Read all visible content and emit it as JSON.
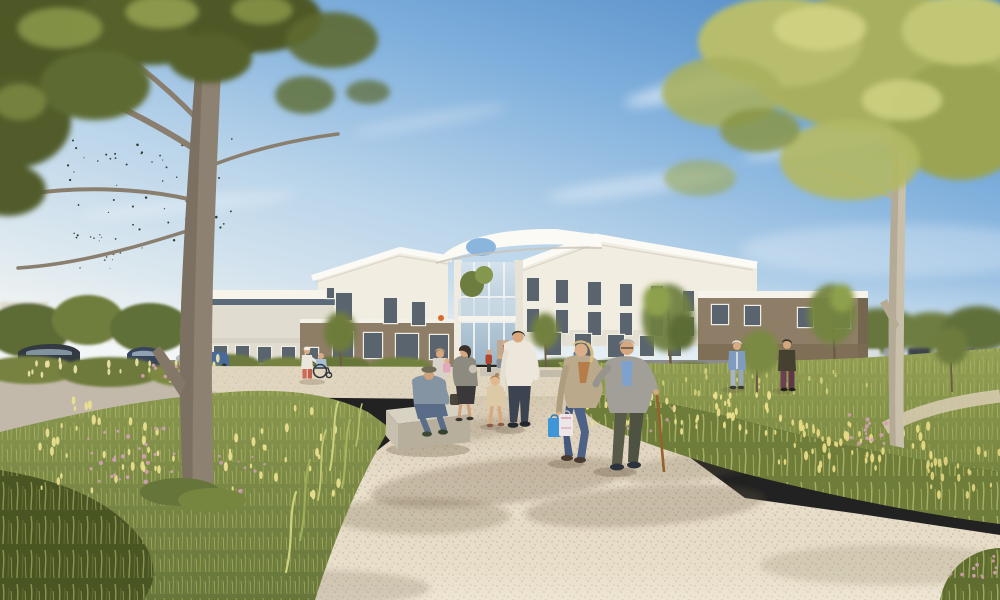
{
  "meta": {
    "type": "architectural-rendering",
    "subject": "Modern low-rise care facility with central glazed entrance, gravel promenade between wildflower meadows, large framing trees, strolling residents and visitors under a blue sky"
  },
  "palette": {
    "sky_top": "#4b86c3",
    "sky_mid": "#8db8e0",
    "sky_low": "#cfe2ec",
    "sky_horizon": "#eaf0f1",
    "cloud": "#ffffff",
    "wall_white": "#f1ede1",
    "wall_white_shade": "#e0dccf",
    "fascia_white": "#fbfaf5",
    "wall_taupe": "#8f7e67",
    "wall_taupe_dark": "#7b6b54",
    "window_glass": "#5a646f",
    "window_frame": "#f0ede3",
    "entrance_glass": "#c2d4e2",
    "gravel": "#e9dfcb",
    "gravel_speck": "#c9b89d",
    "plaza": "#e0d5bf",
    "asphalt": "#c3b9ab",
    "meadow_base": "#7e8c48",
    "meadow_light": "#a9b25e",
    "meadow_dark": "#5a6830",
    "grass_corner_dark": "#4a5524",
    "flower_yellow": "#ece28c",
    "flower_pink": "#d49fb6",
    "foliage_dark": "#4d5828",
    "foliage_mid": "#6e7a38",
    "foliage_light": "#9aa656",
    "foliage_right_mid": "#a8b05e",
    "foliage_right_light": "#c9cd7d",
    "trunk": "#8d8171",
    "trunk_shade": "#6e6355",
    "pale_trunk": "#c9c0ac",
    "path_shadow": "#6b5b43",
    "bench_top": "#d8d2c3",
    "bench_front": "#b7ae9c",
    "cane": "#96612f",
    "car_dark": "#333a42",
    "car_blue": "#36455c",
    "car_silver": "#b5bcc2",
    "roof_terracotta": "#9b6a52"
  },
  "scene": {
    "sky": {
      "birds_flock": "small flock of birds between tree branches, upper left"
    },
    "building": {
      "wings": [
        {
          "id": "left-low-wing",
          "desc": "single-storey white wing with dark clerestory band"
        },
        {
          "id": "left-gable-block",
          "desc": "two-storey white block with angled gable roof"
        },
        {
          "id": "ground-floor-taupe",
          "desc": "taupe ground-floor section with dark openings"
        },
        {
          "id": "entrance-atrium",
          "desc": "central glazed entrance with white sculptural canopy, oval roof cut-out, balcony with planting"
        },
        {
          "id": "right-gable-block",
          "desc": "three-storey white block with folded gable roof"
        },
        {
          "id": "right-brown-wing",
          "desc": "flat-roofed taupe wing with white fascia"
        }
      ],
      "windows": [
        [
          214,
          346,
          13,
          16
        ],
        [
          236,
          346,
          13,
          16
        ],
        [
          258,
          347,
          13,
          16
        ],
        [
          282,
          347,
          13,
          16
        ],
        [
          306,
          348,
          12,
          15
        ],
        [
          336,
          293,
          16,
          27
        ],
        [
          384,
          298,
          13,
          25
        ],
        [
          412,
          302,
          13,
          23
        ],
        [
          327,
          288,
          7,
          10
        ],
        [
          333,
          332,
          20,
          26
        ],
        [
          364,
          333,
          18,
          25
        ],
        [
          396,
          334,
          22,
          26
        ],
        [
          430,
          335,
          18,
          24
        ],
        [
          527,
          278,
          12,
          23
        ],
        [
          556,
          280,
          12,
          23
        ],
        [
          588,
          282,
          13,
          23
        ],
        [
          620,
          284,
          12,
          22
        ],
        [
          651,
          286,
          12,
          22
        ],
        [
          683,
          291,
          11,
          20
        ],
        [
          527,
          309,
          12,
          23
        ],
        [
          556,
          310,
          12,
          23
        ],
        [
          588,
          312,
          13,
          23
        ],
        [
          620,
          313,
          12,
          22
        ],
        [
          651,
          315,
          12,
          21
        ],
        [
          683,
          317,
          11,
          19
        ],
        [
          545,
          333,
          16,
          22
        ],
        [
          575,
          334,
          16,
          22
        ],
        [
          608,
          335,
          16,
          22
        ],
        [
          640,
          336,
          14,
          20
        ],
        [
          668,
          337,
          13,
          19
        ],
        [
          712,
          305,
          16,
          19
        ],
        [
          745,
          306,
          15,
          19
        ],
        [
          798,
          308,
          15,
          19
        ],
        [
          834,
          309,
          16,
          19
        ]
      ]
    },
    "people": [
      {
        "id": "elderly-man-with-cane",
        "desc": "elderly man, grey blazer, blue shirt, olive trousers, wooden cane, walking toward viewer"
      },
      {
        "id": "woman-with-bags",
        "desc": "blonde woman in beige cardigan and jeans carrying blue and white shopping bags, arm in arm with the man"
      },
      {
        "id": "man-white-shirt",
        "desc": "man in white shirt and dark jeans walking away holding a little girl's hand"
      },
      {
        "id": "little-girl",
        "desc": "small girl in beige dress"
      },
      {
        "id": "woman-grey-jacket",
        "desc": "woman in grey-olive jacket and dark skirt, profile"
      },
      {
        "id": "seated-man-bench",
        "desc": "elderly man with flat cap seated on concrete bench"
      },
      {
        "id": "woman-with-child",
        "desc": "woman holding a toddler in pink"
      },
      {
        "id": "wheelchair-pair",
        "desc": "carer in white top and coral trousers pushing person in wheelchair"
      },
      {
        "id": "right-path-pair",
        "desc": "white-haired woman in denim jacket and man in dark jacket on meadow path"
      },
      {
        "id": "entrance-group",
        "desc": "small figures seated and standing by the entrance planters"
      }
    ],
    "vehicles": [
      {
        "id": "parked-cars-left",
        "desc": "dark SUVs and silver car in left parking area"
      },
      {
        "id": "parked-cars-right",
        "desc": "distant row of parked cars behind right meadow"
      }
    ],
    "vegetation": [
      {
        "id": "big-tree-left",
        "desc": "large tree with dark olive canopy framing upper left"
      },
      {
        "id": "tree-right",
        "desc": "pale-trunked tree with yellow-green canopy framing upper right"
      },
      {
        "id": "meadow-left",
        "desc": "wild grass meadow with yellow spikes and pink flowers"
      },
      {
        "id": "meadow-right-band",
        "desc": "diagonal wildflower band with yellow and pink blooms"
      },
      {
        "id": "hedges-building",
        "desc": "clipped shrub row along building base"
      }
    ],
    "scatter": [
      {
        "target": "#birds",
        "seed": 7,
        "count": 64,
        "region": [
          68,
          132,
          165,
          118
        ],
        "rmin": 0.5,
        "rmax": 1.3,
        "color": "#262a21",
        "shape": "dot",
        "opacity": 0.9
      },
      {
        "target": "#birds",
        "seed": 19,
        "count": 14,
        "region": [
          60,
          228,
          70,
          48
        ],
        "rmin": 0.4,
        "rmax": 1.0,
        "color": "#262a21",
        "shape": "dot",
        "opacity": 0.8
      },
      {
        "target": "#hedge-flowers-left",
        "seed": 3,
        "count": 26,
        "region": [
          15,
          358,
          225,
          20
        ],
        "rmin": 1.0,
        "rmax": 1.9,
        "color": "#e9e2a8",
        "shape": "spike",
        "opacity": 0.95
      },
      {
        "target": "#hedge-flowers-left",
        "seed": 11,
        "count": 12,
        "region": [
          130,
          362,
          80,
          16
        ],
        "rmin": 1.2,
        "rmax": 2.0,
        "color": "#d49fb6",
        "shape": "dot",
        "opacity": 0.9
      },
      {
        "target": "#meadow-left-flowers",
        "seed": 23,
        "count": 70,
        "region": [
          40,
          400,
          300,
          95
        ],
        "rmin": 1.0,
        "rmax": 2.2,
        "color": "#e9df8e",
        "shape": "spike",
        "opacity": 0.95
      },
      {
        "target": "#meadow-left-flowers",
        "seed": 31,
        "count": 26,
        "region": [
          88,
          428,
          90,
          55
        ],
        "rmin": 1.2,
        "rmax": 2.4,
        "color": "#d29fb4",
        "shape": "dot",
        "opacity": 0.95
      },
      {
        "target": "#meadow-left-flowers",
        "seed": 41,
        "count": 10,
        "region": [
          200,
          455,
          70,
          40
        ],
        "rmin": 1.0,
        "rmax": 2.0,
        "color": "#cf9ab0",
        "shape": "dot",
        "opacity": 0.9
      },
      {
        "target": "#band-flowers",
        "seed": 53,
        "count": 48,
        "region": [
          585,
          395,
          200,
          38
        ],
        "rmin": 1.0,
        "rmax": 2.0,
        "color": "#ecdf8c",
        "shape": "spike",
        "opacity": 0.95
      },
      {
        "target": "#band-flowers",
        "seed": 61,
        "count": 48,
        "region": [
          770,
          420,
          170,
          52
        ],
        "rmin": 1.0,
        "rmax": 2.2,
        "color": "#e8da84",
        "shape": "spike",
        "opacity": 0.95
      },
      {
        "target": "#band-flowers",
        "seed": 71,
        "count": 22,
        "region": [
          920,
          450,
          80,
          45
        ],
        "rmin": 1.0,
        "rmax": 2.0,
        "color": "#e4d67f",
        "shape": "spike",
        "opacity": 0.9
      },
      {
        "target": "#band-flowers",
        "seed": 83,
        "count": 14,
        "region": [
          845,
          413,
          60,
          35
        ],
        "rmin": 1.2,
        "rmax": 2.2,
        "color": "#d49fb6",
        "shape": "dot",
        "opacity": 0.9
      },
      {
        "target": "#band-flowers",
        "seed": 89,
        "count": 10,
        "region": [
          620,
          403,
          55,
          28
        ],
        "rmin": 1.0,
        "rmax": 1.8,
        "color": "#cf9ab0",
        "shape": "dot",
        "opacity": 0.85
      },
      {
        "target": "#right-meadow-flowers",
        "seed": 97,
        "count": 26,
        "region": [
          580,
          368,
          300,
          26
        ],
        "rmin": 0.8,
        "rmax": 1.6,
        "color": "#dcd47f",
        "shape": "spike",
        "opacity": 0.8
      },
      {
        "target": "#corner-tuft-flowers",
        "seed": 101,
        "count": 12,
        "region": [
          950,
          552,
          48,
          38
        ],
        "rmin": 1.2,
        "rmax": 2.0,
        "color": "#d49fb6",
        "shape": "dot",
        "opacity": 0.9
      }
    ]
  }
}
